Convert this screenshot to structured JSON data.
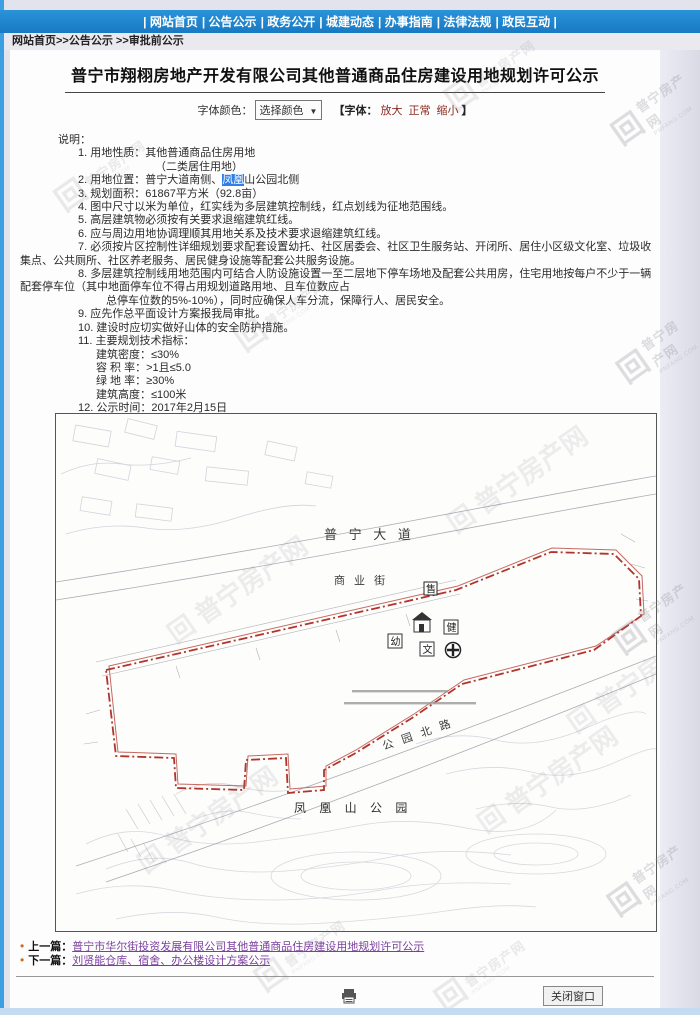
{
  "nav": {
    "items": [
      "网站首页",
      "公告公示",
      "政务公开",
      "城建动态",
      "办事指南",
      "法律法规",
      "政民互动"
    ]
  },
  "breadcrumb": "网站首页>>公告公示 >>审批前公示",
  "page": {
    "title": "普宁市翔栩房地产开发有限公司其他普通商品住房建设用地规划许可公示"
  },
  "font_controls": {
    "color_label": "字体颜色：",
    "color_select_value": "选择颜色",
    "caret": "▼",
    "font_group_open": "【字体：",
    "enlarge": "放大",
    "normal": "正常",
    "shrink": "缩小",
    "font_group_close": "】"
  },
  "notes": {
    "heading": "说明：",
    "lines": [
      {
        "t": "1. 用地性质：其他普通商品住房用地"
      },
      {
        "t": "（二类居住用地）"
      },
      {
        "t": "3. 规划面积：61867平方米（92.8亩）"
      },
      {
        "t": "4. 图中尺寸以米为单位，红实线为多层建筑控制线，红点划线为征地范围线。"
      },
      {
        "t": "5. 高层建筑物必须按有关要求退缩建筑红线。"
      },
      {
        "t": "6. 应与周边用地协调理顺其用地关系及技术要求退缩建筑红线。"
      },
      {
        "t": "7. 必须按片区控制性详细规划要求配套设置幼托、社区居委会、社区卫生服务站、开闭所、居住小区级文化室、垃圾收集点、公共厕所、社区养老服务、居民健身设施等配套公共服务设施。"
      },
      {
        "t": "8. 多层建筑控制线用地范围内可结合人防设施设置一至二层地下停车场地及配套公共用房，住宅用地按每户不少于一辆配套停车位（其中地面停车位不得占用规划道路用地、且车位数应占"
      },
      {
        "t": "总停车位数的5%-10%），同时应确保人车分流，保障行人、居民安全。"
      },
      {
        "t": "9. 应先作总平面设计方案报我局审批。"
      },
      {
        "t": "10. 建设时应切实做好山体的安全防护措施。"
      },
      {
        "t": "11. 主要规划技术指标："
      },
      {
        "t": "建筑密度：≤30%"
      },
      {
        "t": "容 积 率：>1且≤5.0"
      },
      {
        "t": "绿 地 率：≥30%"
      },
      {
        "t": "建筑高度：≤100米"
      },
      {
        "t": "12. 公示时间：2017年2月15日"
      }
    ],
    "location": {
      "pre": "2. 用地位置：普宁大道南侧、",
      "highlight": "凤凰",
      "post": "山公园北侧"
    },
    "email_label": "邮箱信箱：",
    "email": "pn_cjj@163.com"
  },
  "map": {
    "labels": {
      "road_main": "普 宁 大 道",
      "street": "商 业 街",
      "park_road": "公 园 北 路",
      "park": "凤 凰 山 公 园"
    },
    "icons": {
      "kindergarten": "幼",
      "culture": "文",
      "health": "健",
      "shop": "售"
    },
    "boundary_color": "#b3342c"
  },
  "watermark": {
    "logo": "回",
    "name": "普宁房产网",
    "domain": "PNFANG.COM"
  },
  "footer": {
    "prev_label": "上一篇：",
    "prev_link": "普宁市华尔街投资发展有限公司其他普通商品住房建设用地规划许可公示",
    "next_label": "下一篇：",
    "next_link": "刘贤能仓库、宿舍、办公楼设计方案公示",
    "close_button": "关闭窗口"
  }
}
